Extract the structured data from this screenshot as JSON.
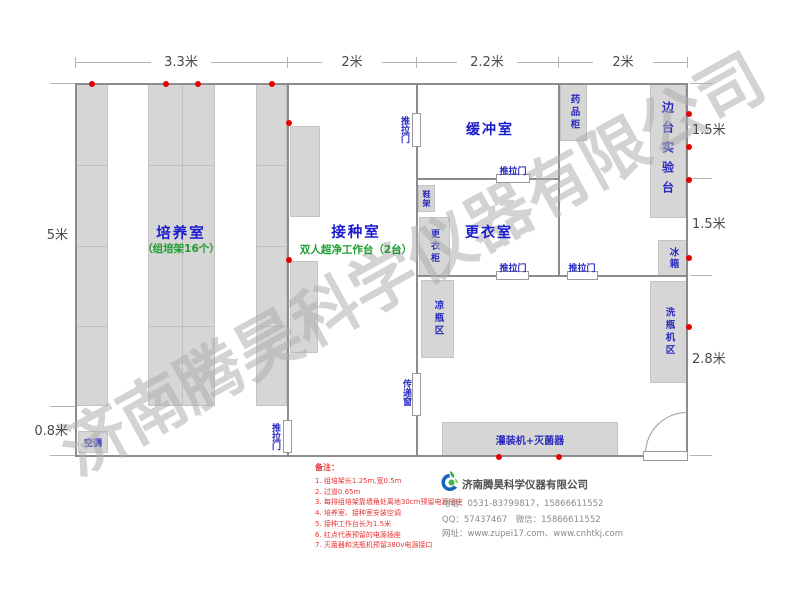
{
  "watermark": "济南腾昊科学仪器有限公司",
  "dimensions": {
    "top": [
      "3.3米",
      "2米",
      "2.2米",
      "2米"
    ],
    "left": [
      "5米",
      "0.8米"
    ],
    "right": [
      "1.5米",
      "1.5米",
      "2.8米"
    ]
  },
  "rooms": {
    "culture_room": {
      "name": "培养室",
      "subtitle": "（组培架16个）"
    },
    "inoculation_room": {
      "name": "接种室",
      "subtitle": "双人超净工作台（2台）"
    },
    "buffer_room": {
      "name": "缓冲室"
    },
    "changing_room": {
      "name": "更衣室"
    },
    "side_bench": {
      "name": "边台实验台"
    }
  },
  "fixtures": {
    "air_conditioner": "空调",
    "sliding_door": "推拉门",
    "transfer_window": "传递窗",
    "shoe_rack": "鞋架",
    "wardrobe": "更衣柜",
    "medicine_cabinet": "药品柜",
    "fridge": "冰箱",
    "cooling_bottle_area": "凉瓶区",
    "bottle_washer_area": "洗瓶机区",
    "filling_machine": "灌装机+灭菌器"
  },
  "notes": {
    "title": "备注：",
    "items": [
      "1. 组培架长1.25m,宽0.5m",
      "2. 过道0.65m",
      "3. 每排组培架靠墙角处离地30cm预留电源插座",
      "4. 培养室、接种室安装空调",
      "5. 接种工作台长为1.5米",
      "6. 红点代表预留的电源插座",
      "7. 灭菌器和洗瓶机预留380v电源接口"
    ]
  },
  "footer": {
    "company": "济南腾昊科学仪器有限公司",
    "phone": "电话：0531-83799817，15866611552",
    "qq": "QQ：57437467　微信：15866611552",
    "website": "网址：www.zupei17.com、www.cnhtkj.com"
  },
  "colors": {
    "room_label": "#1a1acd",
    "sub_label": "#1f9e30",
    "fixture_label": "#2a2ac0",
    "note_red": "#e83535",
    "socket_red": "#e80000",
    "furniture_fill": "#d6d6d6",
    "wall": "#8c8c8c",
    "watermark": "#d8d8d8"
  }
}
